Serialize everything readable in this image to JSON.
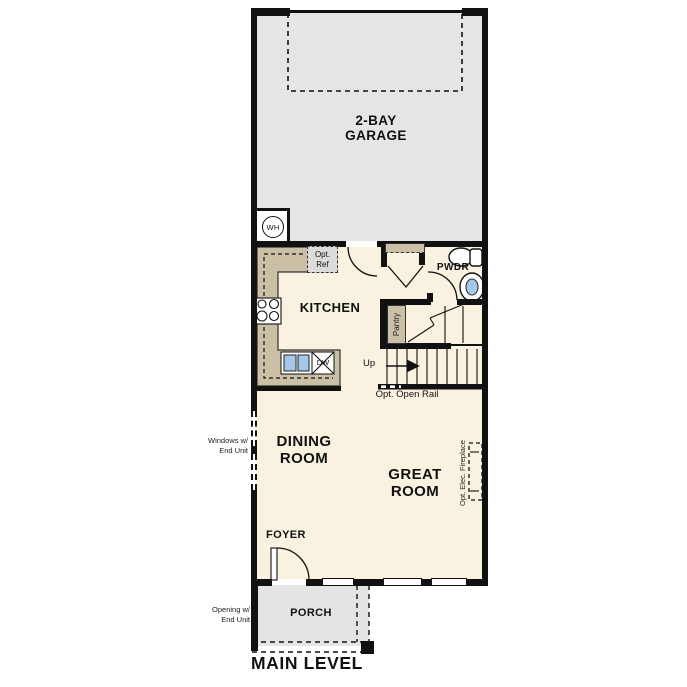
{
  "title": "MAIN LEVEL",
  "colors": {
    "wall": "#111111",
    "text": "#111111",
    "garage_fill": "#e5e5e3",
    "floor_fill": "#f9f2e0",
    "porch_fill": "#e4e4e2",
    "counter_fill": "#cbbfa5",
    "fixture_blue": "#a5c7e9",
    "optref_fill": "#dcdcda"
  },
  "rooms": {
    "garage": {
      "line1": "2-BAY",
      "line2": "GARAGE"
    },
    "kitchen": {
      "label": "KITCHEN"
    },
    "pwdr": {
      "label": "PWDR"
    },
    "pantry": {
      "label": "Pantry"
    },
    "dining": {
      "line1": "DINING",
      "line2": "ROOM"
    },
    "great": {
      "line1": "GREAT",
      "line2": "ROOM"
    },
    "foyer": {
      "label": "FOYER"
    },
    "porch": {
      "label": "PORCH"
    }
  },
  "fixtures": {
    "water_heater": "WH",
    "dishwasher": "DW",
    "opt_ref": {
      "line1": "Opt.",
      "line2": "Ref"
    }
  },
  "stairs": {
    "up": "Up",
    "open_rail": "Opt. Open Rail"
  },
  "annotations": {
    "windows_end_unit": {
      "line1": "Windows w/",
      "line2": "End Unit"
    },
    "opening_end_unit": {
      "line1": "Opening w/",
      "line2": "End Unit"
    },
    "fireplace": "Opt. Elec. Fireplace"
  }
}
